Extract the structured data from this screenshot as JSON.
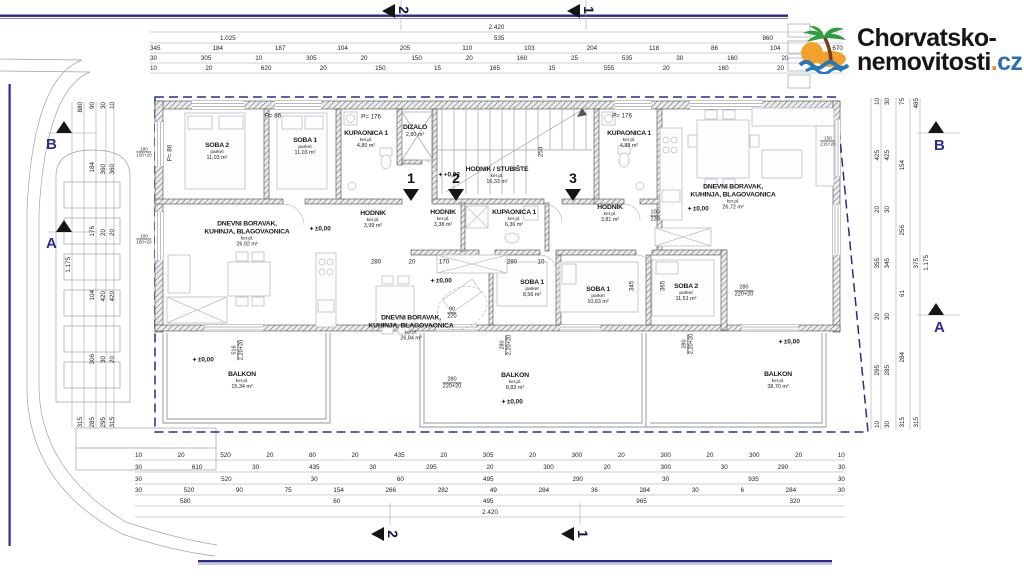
{
  "logo": {
    "line1": "Chorvatsko-",
    "line2": "nemovitosti",
    "dot": ".",
    "tld": "cz"
  },
  "symbols": {
    "level": "✦"
  },
  "colors": {
    "plot_boundary": "#2a2a90",
    "section_letter": "#2b2b8f",
    "logo_dot": "#ef8b1e",
    "logo_cz": "#2e6cb4",
    "wall_hatch": "#4a4a4a"
  },
  "rooms": [
    {
      "title1": "SOBA 2",
      "floor": "parket",
      "area": "11,03 m²"
    },
    {
      "title1": "SOBA 1",
      "floor": "parket",
      "area": "11,03 m²"
    },
    {
      "title1": "KUPAONICA 1",
      "floor": "ker.pl.",
      "area": "4,80 m²"
    },
    {
      "title1": "DIZALO",
      "floor": "",
      "area": "2,80 m²"
    },
    {
      "title1": "HODNIK / STUBIŠTE",
      "floor": "ker.pl.",
      "area": "16,33 m²"
    },
    {
      "title1": "KUPAONICA 1",
      "floor": "ker.pl.",
      "area": "4,88 m²"
    },
    {
      "title1": "DNEVNI BORAVAK,",
      "title2": "KUHINJA, BLAGOVAONICA",
      "floor": "ker.pl.",
      "area": "26,72 m²"
    },
    {
      "title1": "HODNIK",
      "floor": "ker.pl.",
      "area": "3,99 m²"
    },
    {
      "title1": "HODNIK",
      "floor": "ker.pl.",
      "area": "3,38 m²"
    },
    {
      "title1": "KUPAONICA 1",
      "floor": "ker.pl.",
      "area": "6,36 m²"
    },
    {
      "title1": "HODNIK",
      "floor": "ker.pl.",
      "area": "3,81 m²"
    },
    {
      "title1": "DNEVNI BORAVAK,",
      "title2": "KUHINJA, BLAGOVAONICA",
      "floor": "ker.pl.",
      "area": "26,92 m²"
    },
    {
      "title1": "DNEVNI BORAVAK,",
      "title2": "KUHINJA, BLAGOVAONICA",
      "floor": "ker.pl.",
      "area": "26,84 m²"
    },
    {
      "title1": "SOBA 1",
      "floor": "parket",
      "area": "8,56 m²"
    },
    {
      "title1": "SOBA 1",
      "floor": "parket",
      "area": "10,63 m²"
    },
    {
      "title1": "SOBA 2",
      "floor": "parket",
      "area": "11,51 m²"
    },
    {
      "title1": "BALKON",
      "floor": "ker.pl.",
      "area": "15,34 m²"
    },
    {
      "title1": "BALKON",
      "floor": "ker.pl.",
      "area": "8,83 m²"
    },
    {
      "title1": "BALKON",
      "floor": "ker.pl.",
      "area": "38,70 m²"
    }
  ],
  "elevations": [
    {
      "text": "±0,00"
    },
    {
      "text": "±0,00"
    },
    {
      "text": "±0,00"
    },
    {
      "text": "±0,00"
    },
    {
      "text": "±0,00"
    },
    {
      "text": "±0,00"
    },
    {
      "text": "+0,02"
    }
  ],
  "parapets": [
    {
      "text": "P= 86"
    },
    {
      "text": "P= 176"
    },
    {
      "text": "P= 176"
    },
    {
      "text": "P= 86"
    }
  ],
  "windows": [
    {
      "top": "180",
      "bottom": "150+20"
    },
    {
      "top": "100",
      "bottom": "150+20"
    },
    {
      "top": "150",
      "bottom": "215+20"
    }
  ],
  "interior_dims": [
    {
      "text": "280"
    },
    {
      "text": "20"
    },
    {
      "text": "170"
    },
    {
      "text": "280"
    },
    {
      "text": "10"
    },
    {
      "text": "345"
    },
    {
      "text": "365"
    },
    {
      "text": "250"
    }
  ],
  "stacked_dims": [
    {
      "top": "90",
      "bottom": "220"
    },
    {
      "top": "280",
      "bottom": "220+20"
    },
    {
      "top": "280",
      "bottom": "220+20"
    },
    {
      "top": "280",
      "bottom": "2,20+20"
    },
    {
      "top": "280",
      "bottom": "2,20+20"
    },
    {
      "top": "516",
      "bottom": "2,20+20"
    },
    {
      "top": "100",
      "bottom": "220"
    }
  ],
  "dims": {
    "top": [
      [
        "2.420"
      ],
      [
        "1.025",
        "535",
        "860"
      ],
      [
        "345",
        "184",
        "187",
        "104",
        "205",
        "110",
        "103",
        "204",
        "118",
        "86",
        "104",
        "670"
      ],
      [
        "30",
        "305",
        "10",
        "305",
        "20",
        "150",
        "20",
        "160",
        "25",
        "535",
        "30",
        "160",
        "20",
        "620"
      ],
      [
        "10",
        "20",
        "620",
        "20",
        "150",
        "15",
        "165",
        "15",
        "555",
        "20",
        "160",
        "20",
        "620"
      ]
    ],
    "bottom": [
      [
        "10",
        "20",
        "520",
        "20",
        "80",
        "20",
        "435",
        "20",
        "305",
        "20",
        "300",
        "20",
        "300",
        "20",
        "300",
        "20",
        "10"
      ],
      [
        "30",
        "610",
        "30",
        "435",
        "30",
        "295",
        "20",
        "300",
        "20",
        "300",
        "30",
        "290",
        "30"
      ],
      [
        "30",
        "520",
        "30",
        "60",
        "495",
        "290",
        "30",
        "935",
        "30"
      ],
      [
        "30",
        "520",
        "90",
        "75",
        "154",
        "266",
        "282",
        "49",
        "284",
        "36",
        "284",
        "30",
        "6",
        "284",
        "30"
      ],
      [
        "580",
        "60",
        "495",
        "965",
        "320"
      ],
      [
        "2.420"
      ]
    ],
    "left": [
      [
        "1.175"
      ],
      [
        "880",
        "315"
      ],
      [
        "90",
        "184",
        "176",
        "104",
        "306",
        "285"
      ],
      [
        "30",
        "360",
        "20",
        "420",
        "30",
        "295"
      ],
      [
        "10",
        "360",
        "20",
        "420",
        "20",
        "315"
      ]
    ],
    "right": [
      [
        "10",
        "425",
        "20",
        "355",
        "20",
        "295",
        "10"
      ],
      [
        "30",
        "425",
        "30",
        "345",
        "30",
        "285",
        "30"
      ],
      [
        "75",
        "154",
        "256",
        "61",
        "284",
        "315"
      ],
      [
        "485",
        "375",
        "315"
      ],
      [
        "1.175"
      ]
    ]
  },
  "section_markers": {
    "top": [
      "2",
      "1"
    ],
    "bottom": [
      "2",
      "1"
    ],
    "plan": [
      "1",
      "2",
      "3"
    ],
    "left": [
      "B",
      "A"
    ],
    "right": [
      "B",
      "A"
    ]
  }
}
